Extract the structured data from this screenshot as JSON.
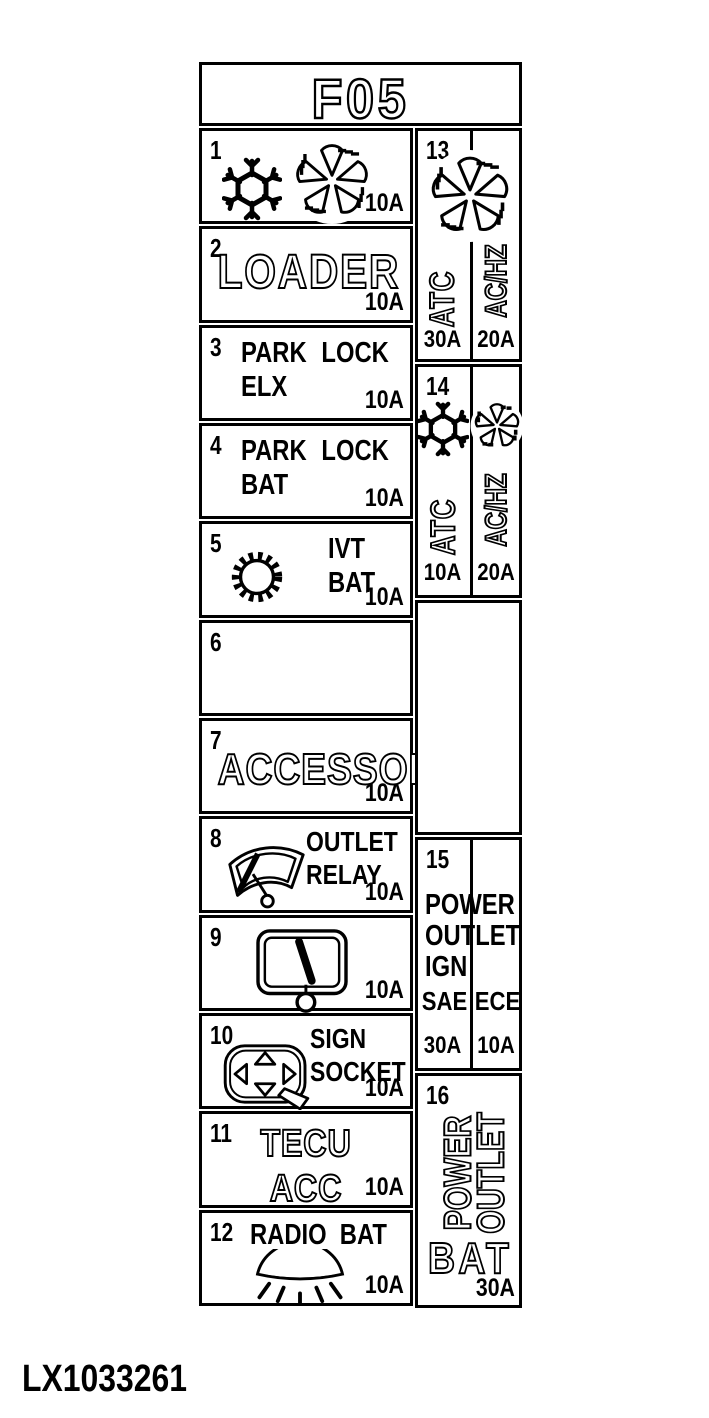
{
  "colors": {
    "ink": "#000000",
    "background": "#ffffff"
  },
  "title": "F05",
  "figure_id": "LX1033261",
  "fuses": {
    "f1": {
      "num": "1",
      "amp": "10A",
      "icons": [
        "snowflake",
        "fan"
      ]
    },
    "f2": {
      "num": "2",
      "label": "LOADER",
      "amp": "10A"
    },
    "f3": {
      "num": "3",
      "line1": "PARK LOCK",
      "line2": "ELX",
      "amp": "10A"
    },
    "f4": {
      "num": "4",
      "line1": "PARK LOCK",
      "line2": "BAT",
      "amp": "10A"
    },
    "f5": {
      "num": "5",
      "line1": "IVT",
      "line2": "BAT",
      "amp": "10A",
      "icons": [
        "gear"
      ]
    },
    "f6": {
      "num": "6"
    },
    "f7": {
      "num": "7",
      "label": "ACCESSORY",
      "amp": "10A"
    },
    "f8": {
      "num": "8",
      "line1": "OUTLET",
      "line2": "RELAY",
      "amp": "10A",
      "icons": [
        "front-wiper"
      ]
    },
    "f9": {
      "num": "9",
      "amp": "10A",
      "icons": [
        "rear-wiper"
      ]
    },
    "f10": {
      "num": "10",
      "line1": "SIGN",
      "line2": "SOCKET",
      "amp": "10A",
      "icons": [
        "mirror-adjust"
      ]
    },
    "f11": {
      "num": "11",
      "line1": "TECU",
      "line2": "ACC",
      "amp": "10A"
    },
    "f12": {
      "num": "12",
      "label": "RADIO BAT",
      "amp": "10A",
      "icons": [
        "lamp"
      ]
    },
    "f13": {
      "num": "13",
      "icons": [
        "fan"
      ],
      "left": {
        "label": "ATC",
        "amp": "30A"
      },
      "right": {
        "label": "AC/HZ",
        "amp": "20A"
      }
    },
    "f14": {
      "num": "14",
      "left": {
        "label": "ATC",
        "amp": "10A",
        "icons": [
          "snowflake"
        ]
      },
      "right": {
        "label": "AC/HZ",
        "amp": "20A",
        "icons": [
          "fan"
        ]
      }
    },
    "f15": {
      "num": "15",
      "line1": "POWER",
      "line2": "OUTLET",
      "line3": "IGN",
      "left": {
        "standard": "SAE",
        "amp": "30A"
      },
      "right": {
        "standard": "ECE",
        "amp": "10A"
      }
    },
    "f16": {
      "num": "16",
      "rot1": "POWER",
      "rot2": "OUTLET",
      "label": "BAT",
      "amp": "30A"
    }
  }
}
